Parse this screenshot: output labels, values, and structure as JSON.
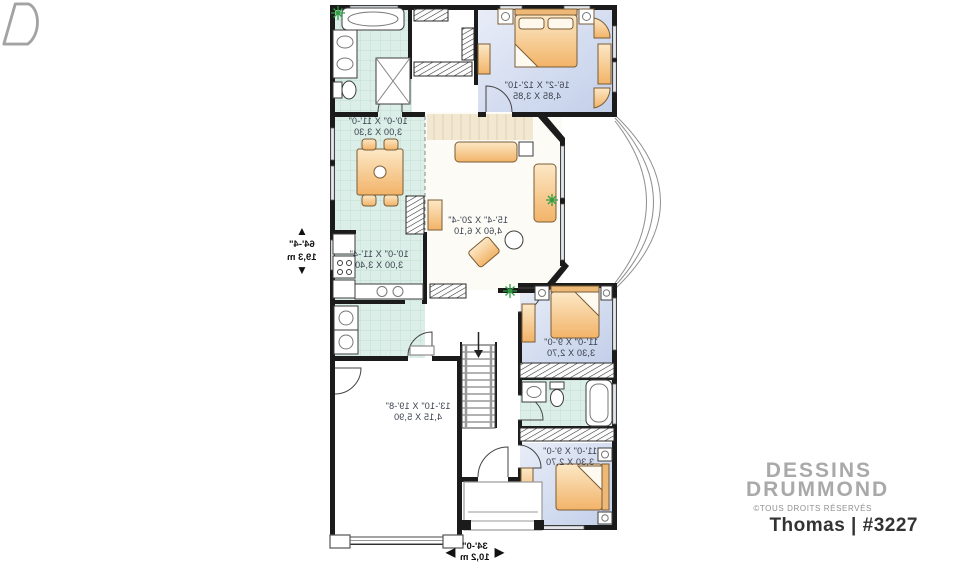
{
  "watermark": {
    "brand_line1": "DESSINS",
    "brand_line2": "DRUMMOND",
    "rights": "©TOUS DROITS RÉSERVÉS",
    "plan_title": "Thomas | #3227",
    "logo_icon": "drummond-d-logo"
  },
  "dimensions": {
    "height": {
      "imperial": "64'-4\"",
      "metric": "19,3 m"
    },
    "width": {
      "imperial": "34'-0\"",
      "metric": "10,2 m"
    }
  },
  "icons": {
    "arrow_up": "▲",
    "arrow_down": "▼",
    "arrow_left": "◀",
    "arrow_right": "▶"
  },
  "plan": {
    "mirrored_labels": true,
    "rooms": [
      {
        "id": "master-bedroom",
        "imperial": "16'-2\" X 12'-10\"",
        "metric": "4,85 X 3,85"
      },
      {
        "id": "dining-room",
        "imperial": "10'-0\" X 11'-0\"",
        "metric": "3,00 X 3,30"
      },
      {
        "id": "kitchen",
        "imperial": "10'-0\" X 11'-4\"",
        "metric": "3,00 X 3,40"
      },
      {
        "id": "living-room",
        "imperial": "15'-4\" X 20'-4\"",
        "metric": "4,60 X 6,10"
      },
      {
        "id": "bedroom-2",
        "imperial": "11'-0\" X 9'-0\"",
        "metric": "3,30 X 2,70"
      },
      {
        "id": "bedroom-3",
        "imperial": "11'-0\" X 9'-0\"",
        "metric": "3,30 X 2,70"
      },
      {
        "id": "garage",
        "imperial": "13'-10\" X 19'-8\"",
        "metric": "4,15 X 5,90"
      }
    ]
  },
  "colors": {
    "wall": "#1b1b1b",
    "bedroom_floor": "#c9d5ec",
    "tile_floor": "#dbeee7",
    "furniture_peach": "#f6c98c",
    "label_text": "#39404d",
    "dim_text": "#111111",
    "watermark_gray": "#a9a9a9",
    "rights_gray": "#8f8f8f",
    "title_text": "#333333",
    "plant_green": "#2f9e44",
    "window_gray": "#e3e7ec"
  }
}
